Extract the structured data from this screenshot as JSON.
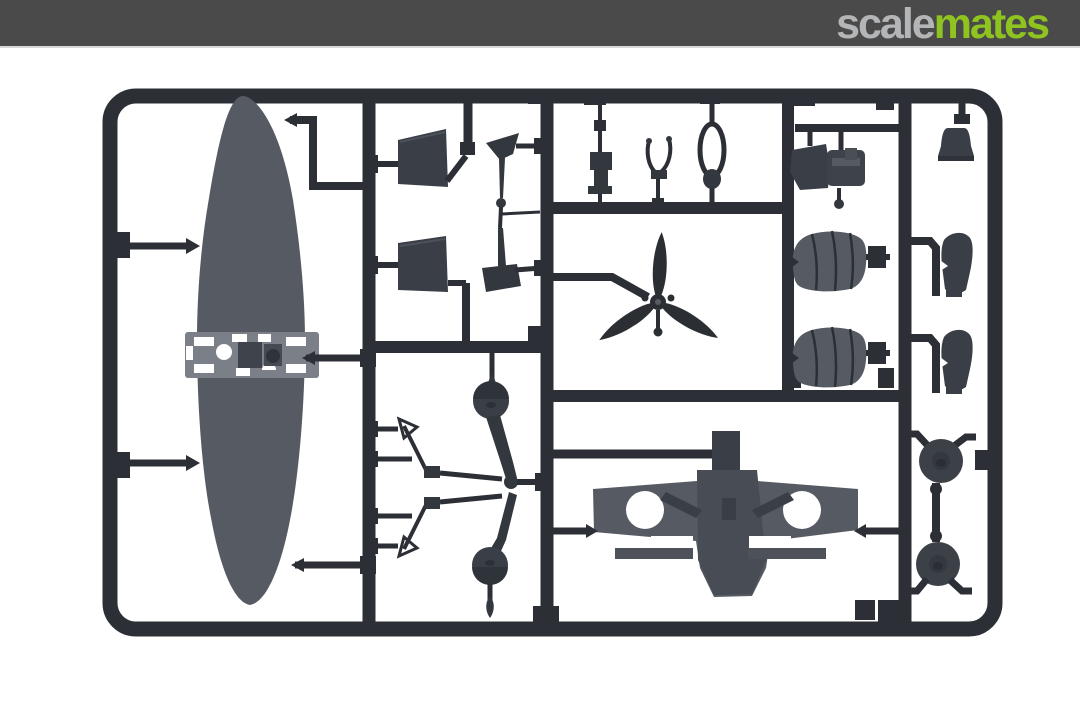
{
  "banner": {
    "brand_prefix": "scale",
    "brand_suffix": "mates",
    "background": "#4a4a4b",
    "prefix_color": "#b3b5b7",
    "suffix_color": "#8fc31f"
  },
  "photo": {
    "description": "Dark grey injection-moulded model kit sprue with aircraft parts on white background",
    "background": "#ffffff",
    "runner_color": "#2c2f35",
    "part_color": "#565a62",
    "parts": [
      "sprue-frame",
      "one-piece-lower-wing",
      "horizontal-stabilizer-left",
      "horizontal-stabilizer-right",
      "spinner-half-top",
      "spinner-half-bottom",
      "control-column",
      "tailwheel-fork",
      "seat-frame",
      "engine-block",
      "tail-cone",
      "three-blade-propeller",
      "cowling-half-top",
      "cowling-half-bottom",
      "exhaust-fairing-top",
      "exhaust-fairing-bottom",
      "antenna-mast-top",
      "antenna-mast-bottom",
      "landing-gear-strut-top",
      "landing-gear-strut-bottom",
      "upper-wing-center-section",
      "main-wheel-top",
      "main-wheel-bottom"
    ]
  }
}
